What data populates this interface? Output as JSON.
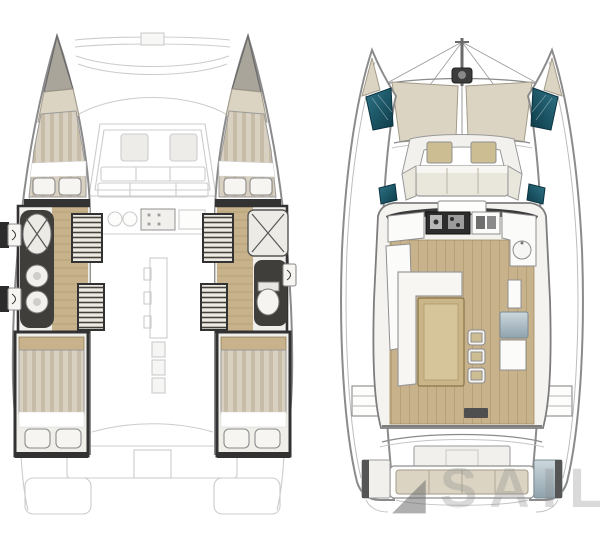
{
  "watermark": {
    "logo_glyph": "◢",
    "text": "SAILO"
  },
  "palette": {
    "background": "#ffffff",
    "hull_outline": "#8b8b8b",
    "ghost_line": "#cccccc",
    "wall": "#323232",
    "wood_floor": "#c7b28b",
    "wood_grain": "#9c8557",
    "cushion_beige": "#dbd4c2",
    "cushion_tan": "#cdbd92",
    "bed_stripe_a": "#d8d0c0",
    "bed_stripe_b": "#c7bca7",
    "teal_light": "#2e7487",
    "teal_dark": "#0d3b48",
    "metal_light": "#ccd8dd",
    "metal_dark": "#8fa3ad",
    "fixture_white": "#f6f5f2",
    "dark_fixture": "#2e2e2e"
  },
  "icons": {
    "shower": "crossed-diagonals",
    "washbasin": "double-circle",
    "toilet": "oval-with-tank",
    "stove": "burner-grid",
    "stairs": "hatched-treads",
    "windlass": "dark-block-with-drum"
  }
}
